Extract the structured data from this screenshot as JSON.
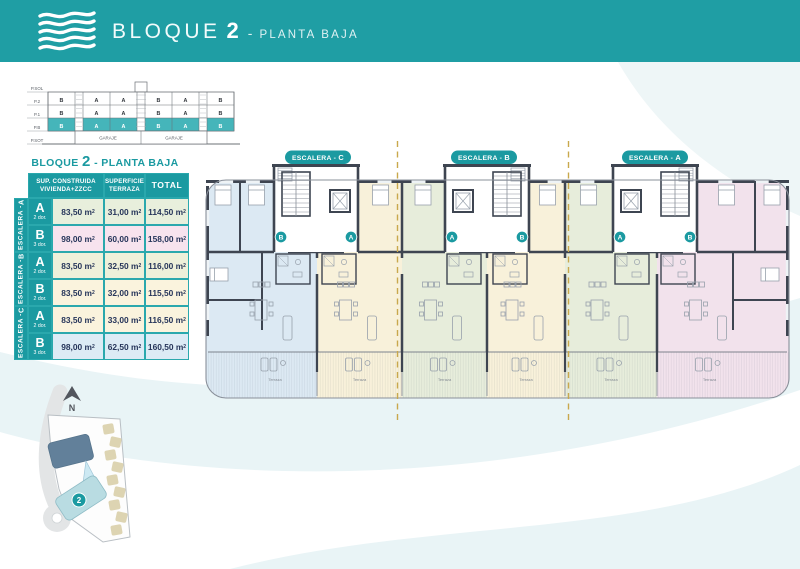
{
  "header": {
    "title_main": "BLOQUE",
    "title_number": "2",
    "separator": "-",
    "title_sub": "PLANTA BAJA"
  },
  "schematic": {
    "floor_labels": [
      "P.SOL",
      "P.2",
      "P.1",
      "P.B",
      "P.SOT"
    ],
    "row_p2": [
      "B",
      "A",
      "A",
      "B",
      "A",
      "B"
    ],
    "row_p1": [
      "B",
      "A",
      "A",
      "B",
      "A",
      "B"
    ],
    "row_pb": [
      "B",
      "A",
      "A",
      "B",
      "A",
      "B"
    ],
    "garage_label": "GARAJE"
  },
  "table": {
    "title": {
      "pre": "BLOQUE",
      "num": "2",
      "post": "- PLANTA BAJA"
    },
    "headers": [
      [
        "SUP. CONSTRUIDA",
        "VIVIENDA+ZZCC"
      ],
      [
        "SUPERFICIE",
        "TERRAZA"
      ],
      [
        "TOTAL"
      ]
    ],
    "unit_base": "m",
    "unit_exp": "2",
    "groups": [
      {
        "label": "ESCALERA - ",
        "letter": "A",
        "rows": [
          {
            "letter": "A",
            "dorms": "2 dor.",
            "construida": "83,50",
            "terraza": "31,00",
            "total": "114,50",
            "bg": "#e8efdc"
          },
          {
            "letter": "B",
            "dorms": "3 dor.",
            "construida": "98,00",
            "terraza": "60,00",
            "total": "158,00",
            "bg": "#f7e3ee"
          }
        ]
      },
      {
        "label": "ESCALERA - ",
        "letter": "B",
        "rows": [
          {
            "letter": "A",
            "dorms": "2 dor.",
            "construida": "83,50",
            "terraza": "32,50",
            "total": "116,00",
            "bg": "#eef0da"
          },
          {
            "letter": "B",
            "dorms": "2 dor.",
            "construida": "83,50",
            "terraza": "32,00",
            "total": "115,50",
            "bg": "#faf3dd"
          }
        ]
      },
      {
        "label": "ESCALERA - ",
        "letter": "C",
        "rows": [
          {
            "letter": "A",
            "dorms": "2 dor.",
            "construida": "83,50",
            "terraza": "33,00",
            "total": "116,50",
            "bg": "#faf3dd"
          },
          {
            "letter": "B",
            "dorms": "3 dor.",
            "construida": "98,00",
            "terraza": "62,50",
            "total": "160,50",
            "bg": "#dcebf5"
          }
        ]
      }
    ]
  },
  "plan": {
    "sections": [
      {
        "label": "ESCALERA - ",
        "letter": "C"
      },
      {
        "label": "ESCALERA - ",
        "letter": "B"
      },
      {
        "label": "ESCALERA - ",
        "letter": "A"
      }
    ],
    "markers": [
      "B",
      "A",
      "A",
      "B",
      "A",
      "B"
    ],
    "terrace_label": "Terraza",
    "colors": {
      "blue": "#dce9f3",
      "cream": "#f8f1da",
      "green": "#e7eddb",
      "pink": "#f2e2ec",
      "teal": "#1b9aa1",
      "dash": "#c9a84c",
      "wall": "#3e4551",
      "light": "#98a1ac"
    }
  },
  "sitemap": {
    "north_label": "N",
    "block_number": "2"
  }
}
